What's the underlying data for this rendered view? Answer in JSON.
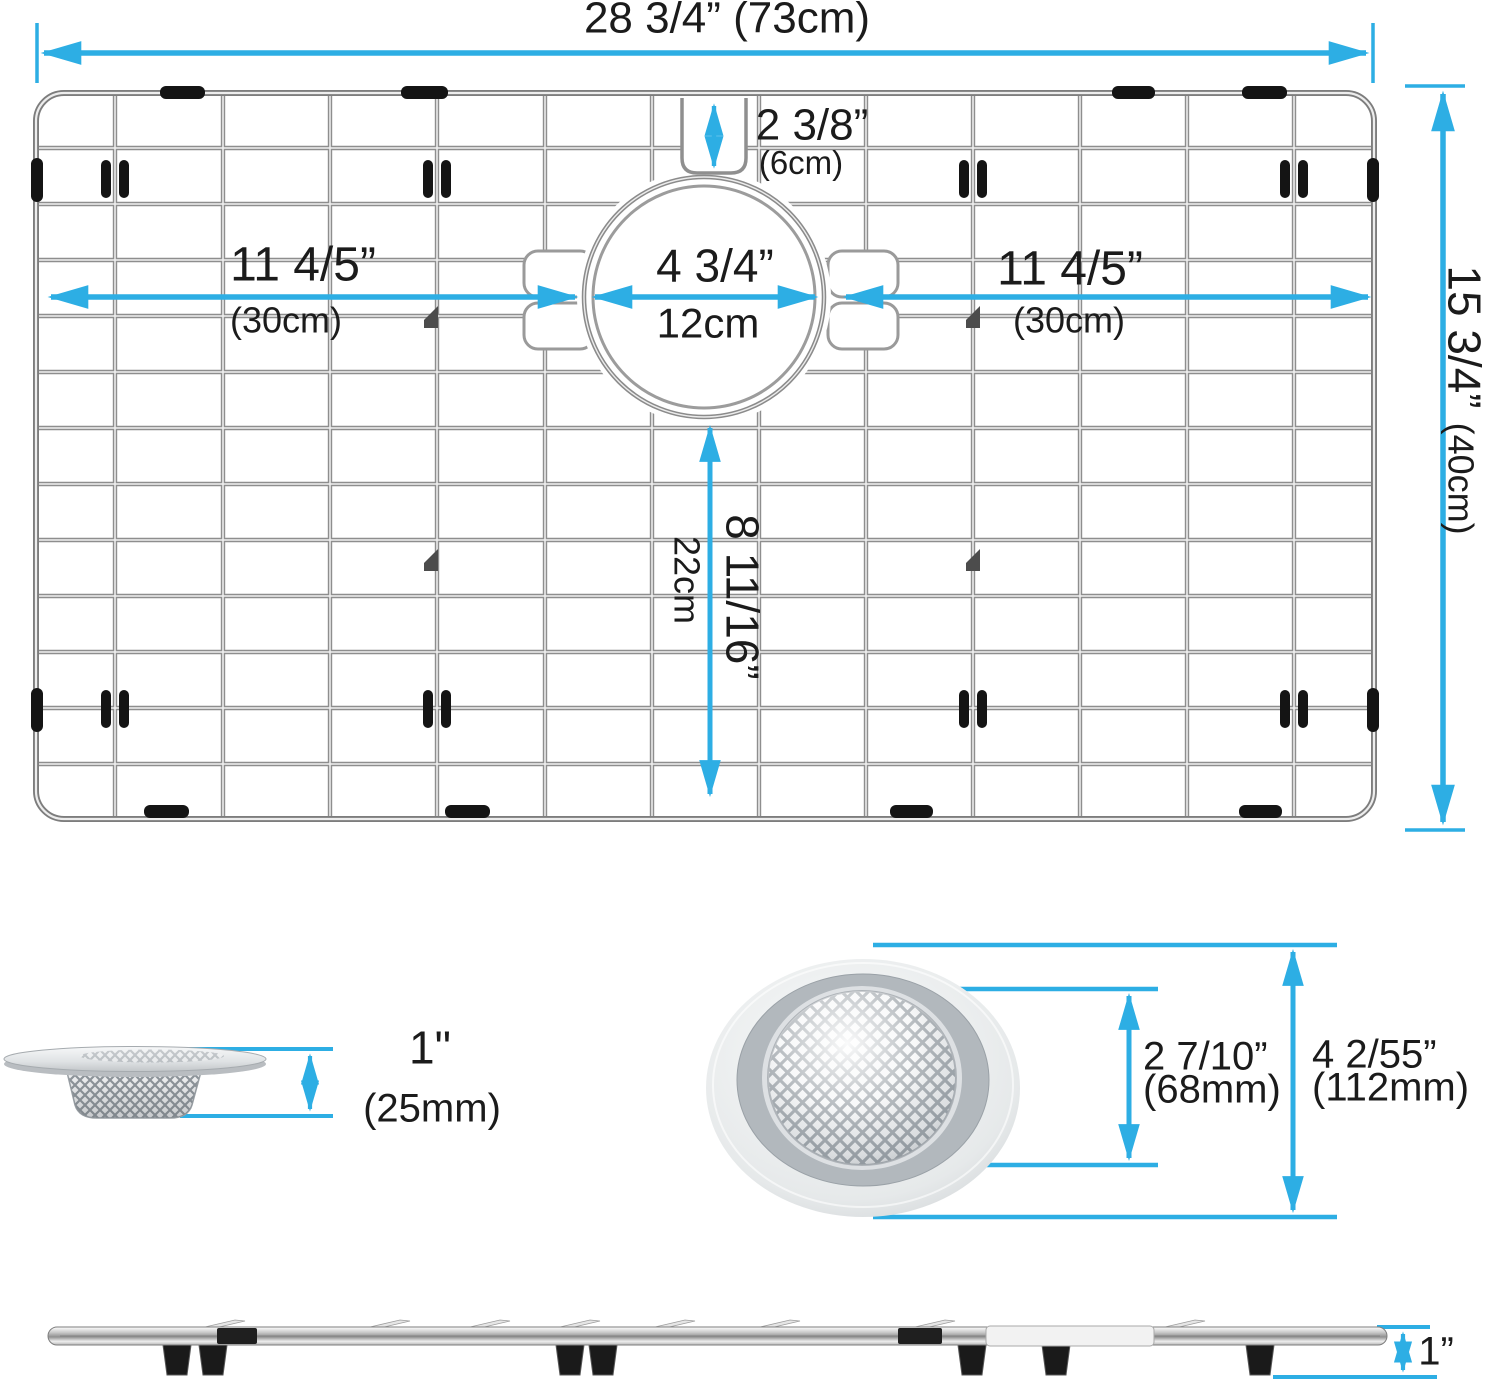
{
  "diagram_title": "sink grid and strainer dimension diagram",
  "colors": {
    "dimension_accent": "#2DAEE4",
    "wire_gray": "#8e8e8e",
    "clip_black": "#141414"
  },
  "labels": {
    "overall_width": "28 3/4” (73cm)",
    "notch": {
      "in": "2 3/8”",
      "metric": "(6cm)"
    },
    "left_span": {
      "in": "11 4/5”",
      "metric": "(30cm)"
    },
    "hole": {
      "in": "4 3/4”",
      "metric": "12cm"
    },
    "right_span": {
      "in": "11 4/5”",
      "metric": "(30cm)"
    },
    "overall_height": {
      "in": "15 3/4”",
      "metric": "(40cm)"
    },
    "hole_to_bottom": {
      "in": "8 11/16”",
      "metric": "22cm"
    },
    "strainer_side": {
      "in": "1\"",
      "metric": "(25mm)"
    },
    "strainer_inner": {
      "in": "2 7/10”",
      "metric": "(68mm)"
    },
    "strainer_outer": {
      "in": "4 2/55”",
      "metric": "(112mm)"
    },
    "profile_height": "1”"
  }
}
